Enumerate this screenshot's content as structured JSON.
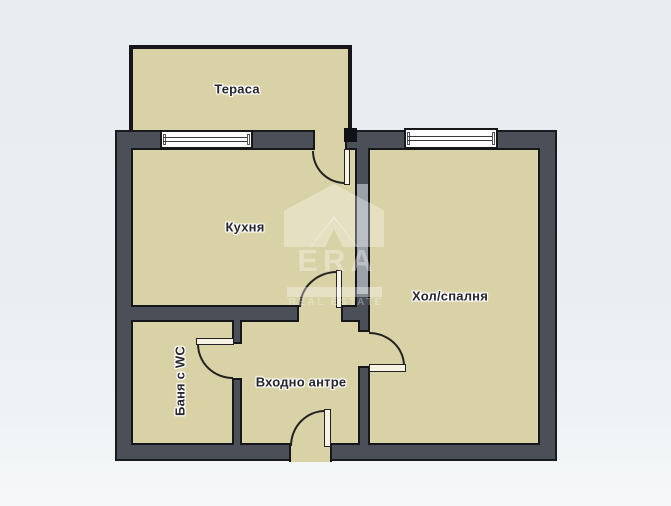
{
  "rooms": {
    "terrace": {
      "label": "Тераса"
    },
    "kitchen": {
      "label": "Кухня"
    },
    "living": {
      "label": "Хол/спалня"
    },
    "hall": {
      "label": "Входно антре"
    },
    "bath": {
      "label": "Баня с WC"
    }
  },
  "watermark": {
    "brand": "ERA",
    "tagline": "REAL ESTATE",
    "logo_icon": "era-house-roof-icon",
    "color": "#ffffff"
  },
  "colors": {
    "background": "#e9eef1",
    "floor": "#d9d2a6",
    "wall": "#4a4f58",
    "wall_light": "#9aa1a9",
    "outline": "#16171b",
    "window": "#fdfdfd",
    "label_text": "#26262e"
  }
}
